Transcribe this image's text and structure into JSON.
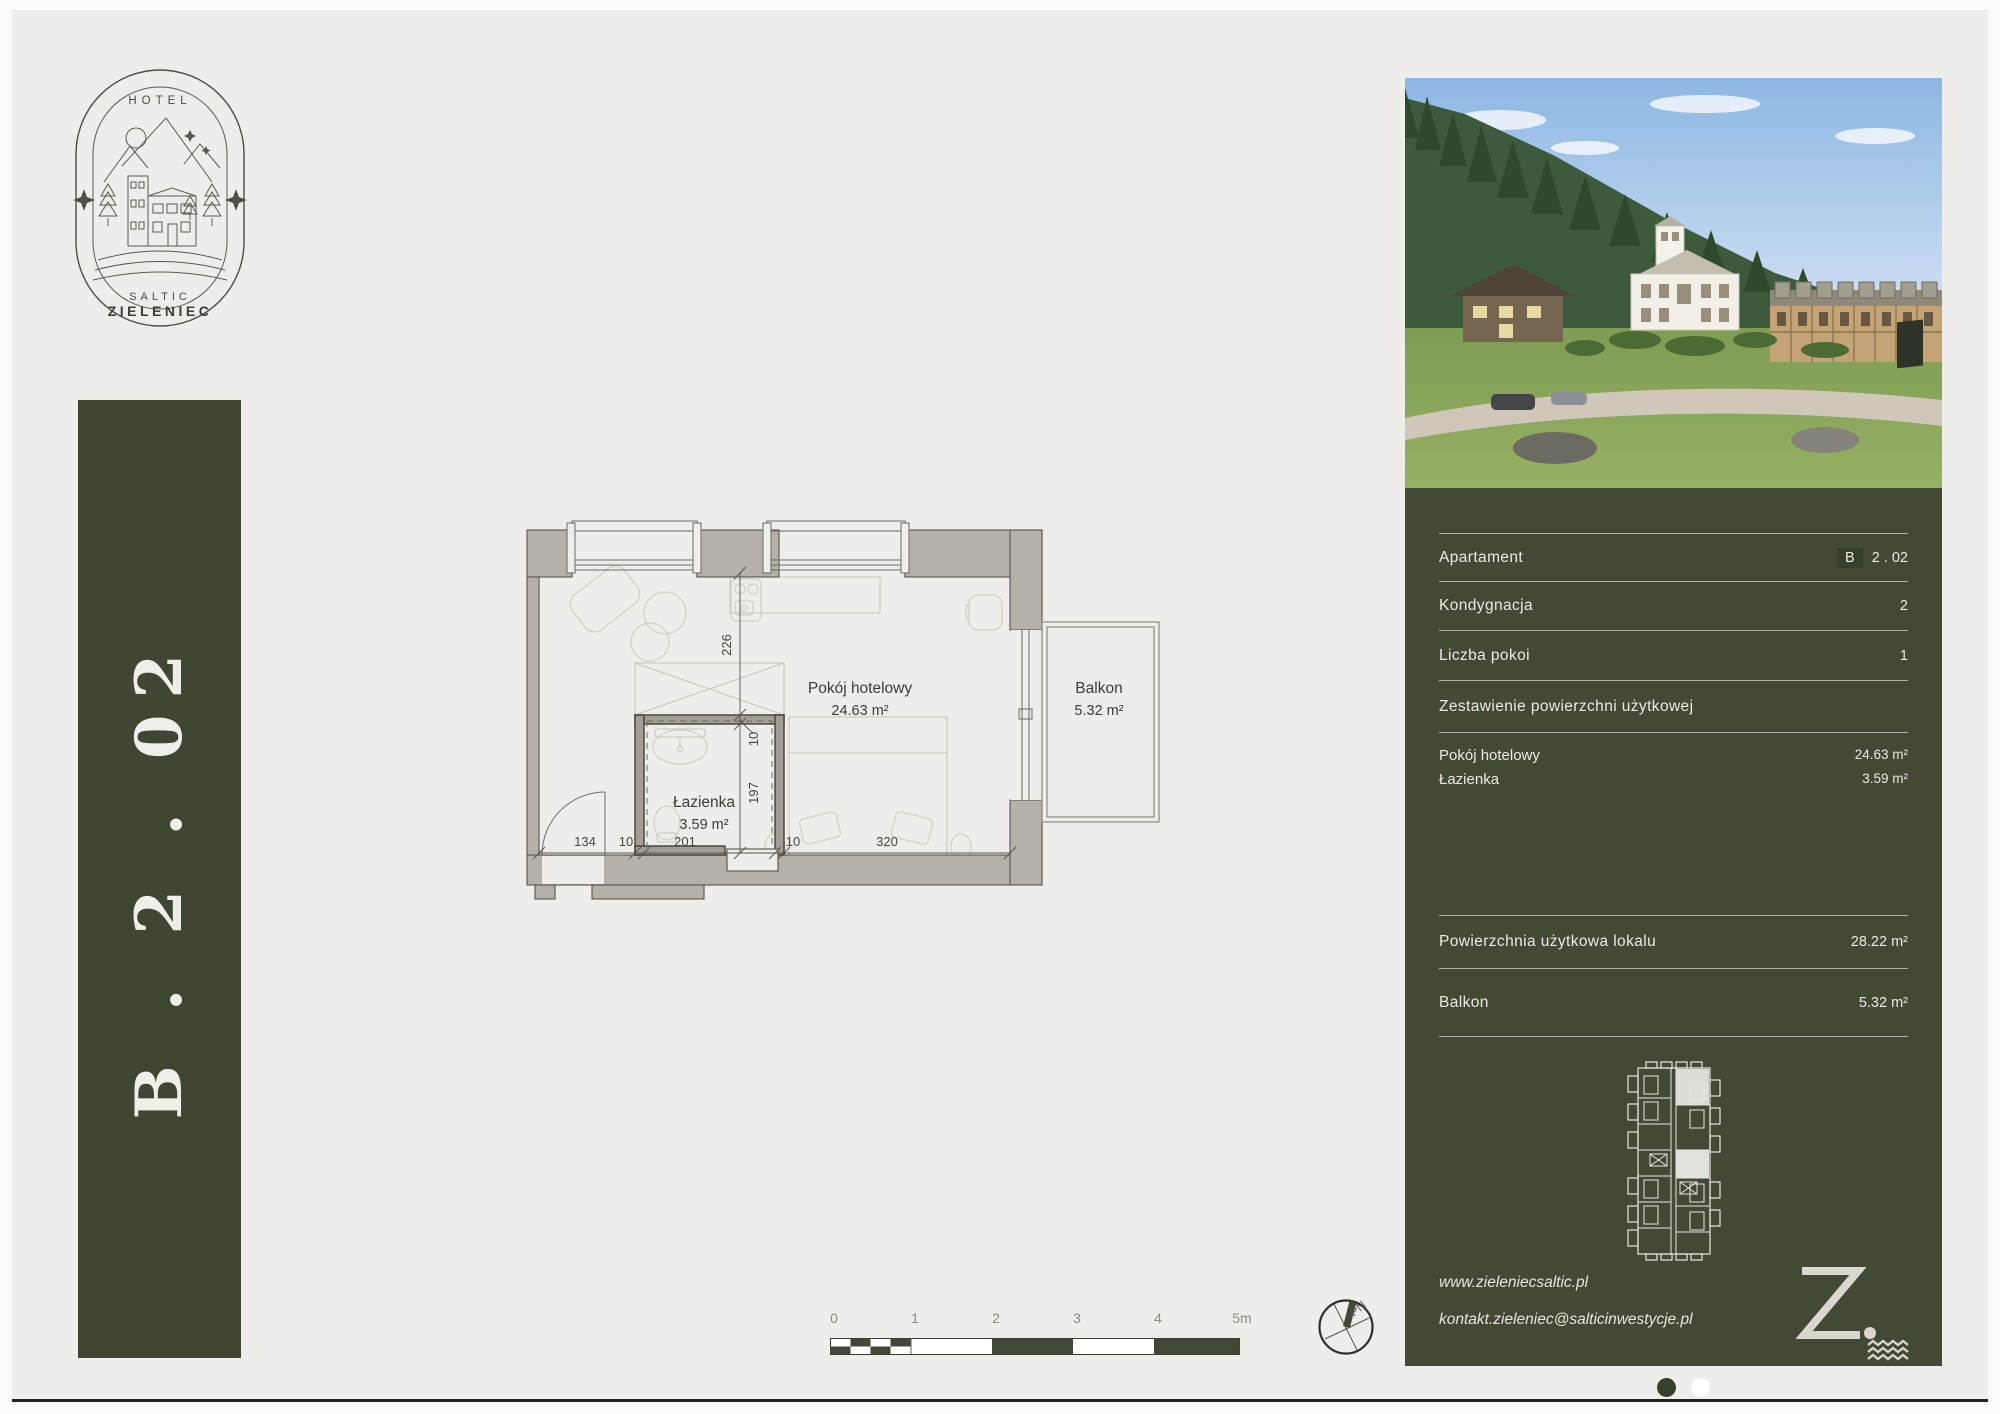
{
  "logo": {
    "hotel": "HOTEL",
    "saltic": "SALTIC",
    "zieleniec": "ZIELENIEC"
  },
  "banner": {
    "apartment_code": "B . 2 . 02"
  },
  "floorplan": {
    "rooms": [
      {
        "name": "Pokój hotelowy",
        "area": "24.63 m²"
      },
      {
        "name": "Łazienka",
        "area": "3.59 m²"
      },
      {
        "name": "Balkon",
        "area": "5.32 m²"
      }
    ],
    "dimensions": {
      "room_depth": "226",
      "wall_top": "10",
      "bath_depth": "197",
      "entry_width": "134",
      "wall_left": "10",
      "bath_width": "201",
      "wall_right": "10",
      "bed_zone_width": "320"
    }
  },
  "scalebar": {
    "labels": [
      "0",
      "1",
      "2",
      "3",
      "4",
      "5m"
    ]
  },
  "compass": {
    "north": "PN"
  },
  "panel": {
    "rows": {
      "apartament": {
        "label": "Apartament",
        "block": "B",
        "value": "2 . 02"
      },
      "kondygnacja": {
        "label": "Kondygnacja",
        "value": "2"
      },
      "liczba": {
        "label": "Liczba pokoi",
        "value": "1"
      },
      "zestawienie": {
        "label": "Zestawienie powierzchni użytkowej"
      }
    },
    "areas": [
      {
        "label": "Pokój hotelowy",
        "value": "24.63 m²"
      },
      {
        "label": "Łazienka",
        "value": "3.59 m²"
      }
    ],
    "totals": [
      {
        "label": "Powierzchnia użytkowa lokalu",
        "value": "28.22 m²"
      },
      {
        "label": "Balkon",
        "value": "5.32 m²"
      }
    ],
    "website": "www.zieleniecsaltic.pl",
    "email": "kontakt.zieleniec@salticinwestycje.pl",
    "brand_letter": "Z."
  },
  "colors": {
    "green": "#424a37",
    "cream": "#f0eee9",
    "wall_gray": "#b5b0a8",
    "page_bg": "#efede9"
  }
}
